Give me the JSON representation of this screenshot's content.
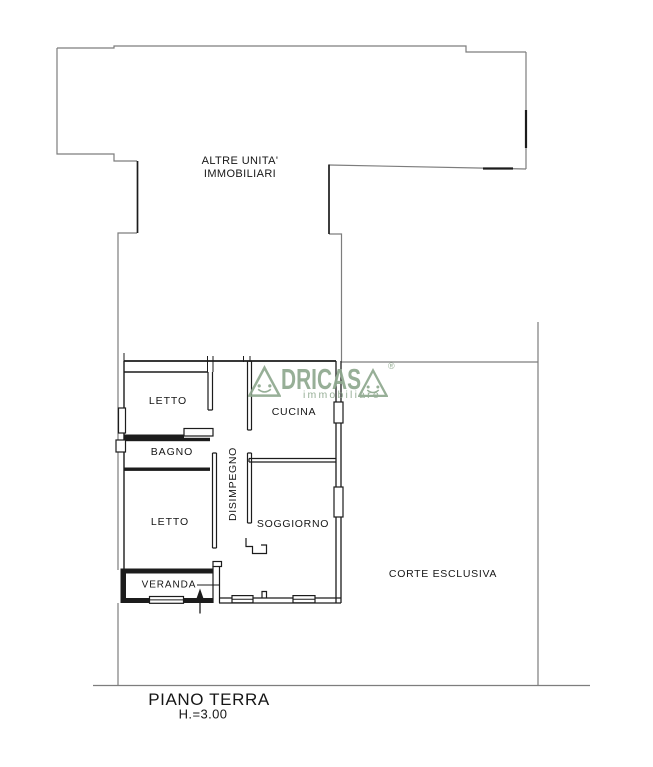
{
  "colors": {
    "line_grey": "#7d7d7d",
    "wall_black": "#1c1c1c",
    "logo_green": "#8fa98f",
    "text_black": "#161616"
  },
  "rooms": {
    "other_units": {
      "line1": "ALTRE UNITA'",
      "line2": "IMMOBILIARI"
    },
    "bedroom_top": "LETTO",
    "kitchen": "CUCINA",
    "bathroom": "BAGNO",
    "hallway": "DISIMPEGNO",
    "bedroom_bottom": "LETTO",
    "living_room": "SOGGIORNO",
    "veranda": "VERANDA",
    "exclusive_courtyard": "CORTE ESCLUSIVA"
  },
  "footer": {
    "floor_title": "PIANO TERRA",
    "ceiling_height": "H.=3.00"
  },
  "watermark": {
    "brand_full": "ADRICASA",
    "brand_mid_letters": "DRICAS",
    "tagline": "immobiliare",
    "registered": "®"
  }
}
